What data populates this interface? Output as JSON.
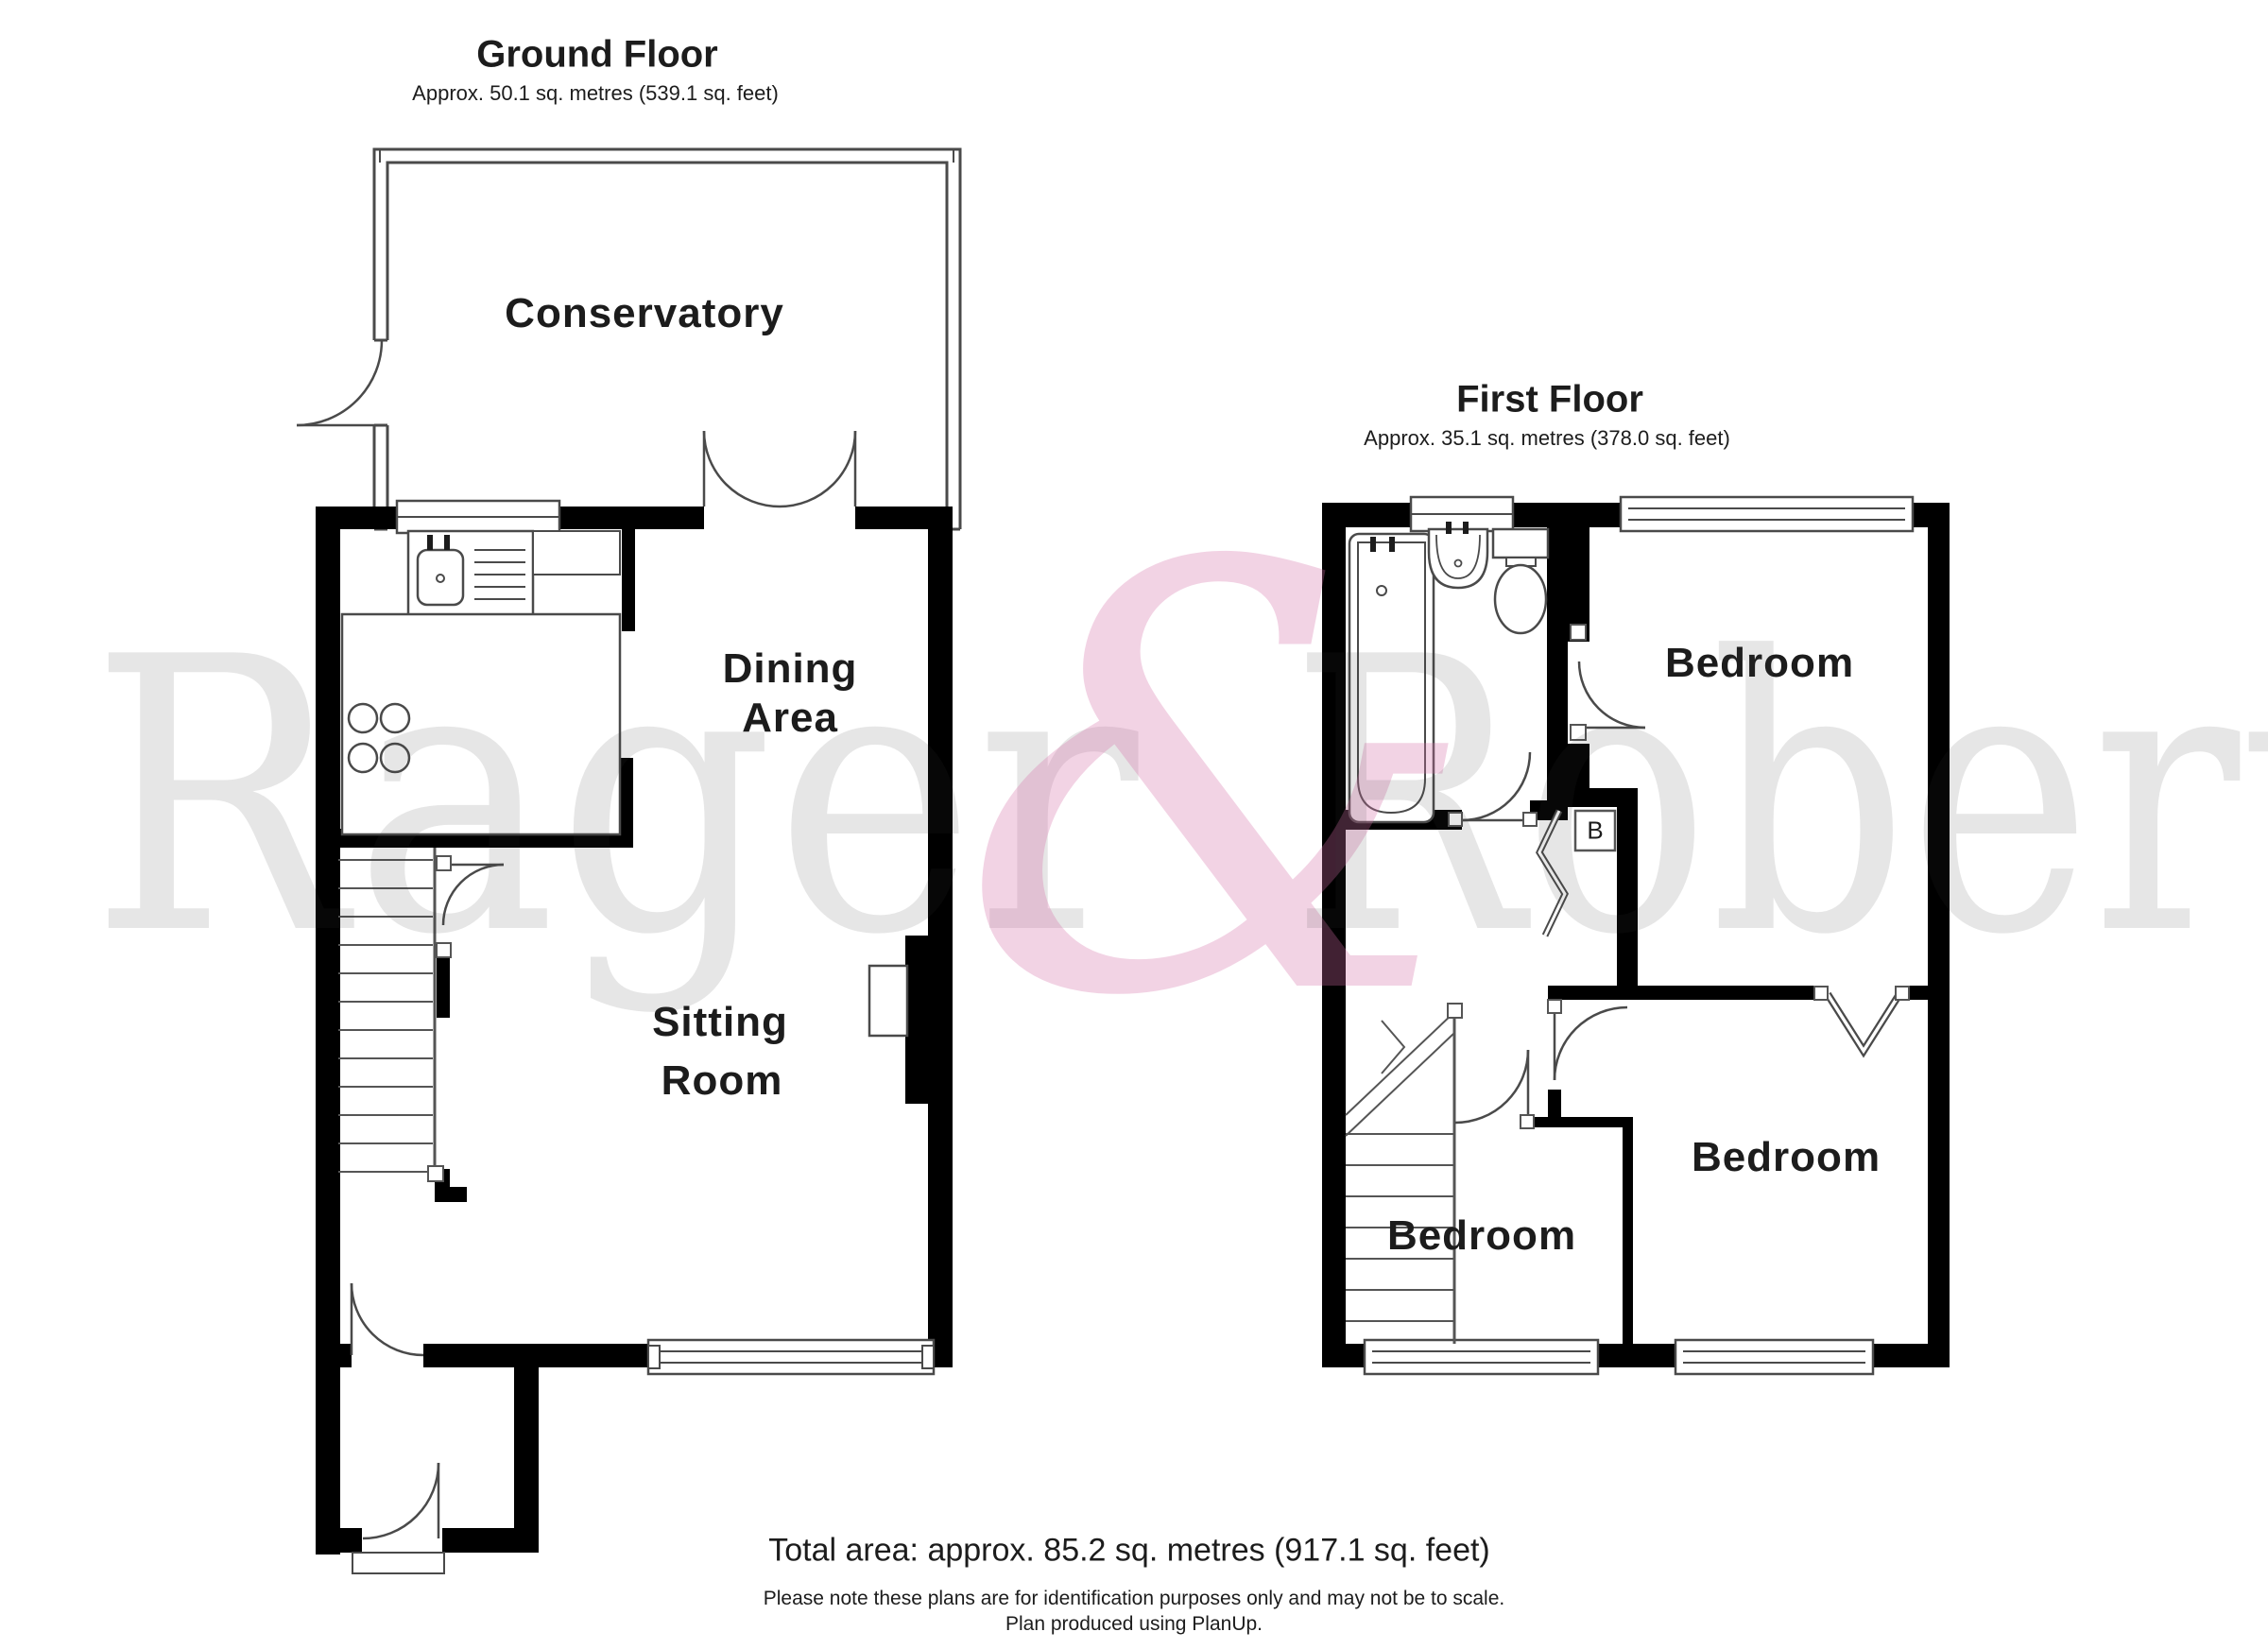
{
  "ground_floor": {
    "title": "Ground Floor",
    "area": "Approx. 50.1 sq. metres (539.1 sq. feet)",
    "rooms": {
      "conservatory": "Conservatory",
      "dining_line1": "Dining",
      "dining_line2": "Area",
      "sitting_line1": "Sitting",
      "sitting_line2": "Room"
    }
  },
  "first_floor": {
    "title": "First Floor",
    "area": "Approx. 35.1 sq. metres (378.0 sq. feet)",
    "rooms": {
      "bedroom_top": "Bedroom",
      "bedroom_bottom_right": "Bedroom",
      "bedroom_bottom_left": "Bedroom"
    },
    "boiler_label": "B"
  },
  "footer": {
    "total_area": "Total area: approx. 85.2 sq. metres (917.1 sq. feet)",
    "note": "Please note these plans are for identification purposes only and may not be to scale.",
    "producer": "Plan produced using PlanUp."
  },
  "watermark": {
    "word1": "Rager",
    "ampersand": "&",
    "word2": "Roberts",
    "color_words": "#e9e9e9",
    "color_ampersand": "#f2d0e2"
  },
  "colors": {
    "walls": "#000000",
    "thin_lines": "#4a4a4a",
    "text": "#1c1c1c"
  }
}
